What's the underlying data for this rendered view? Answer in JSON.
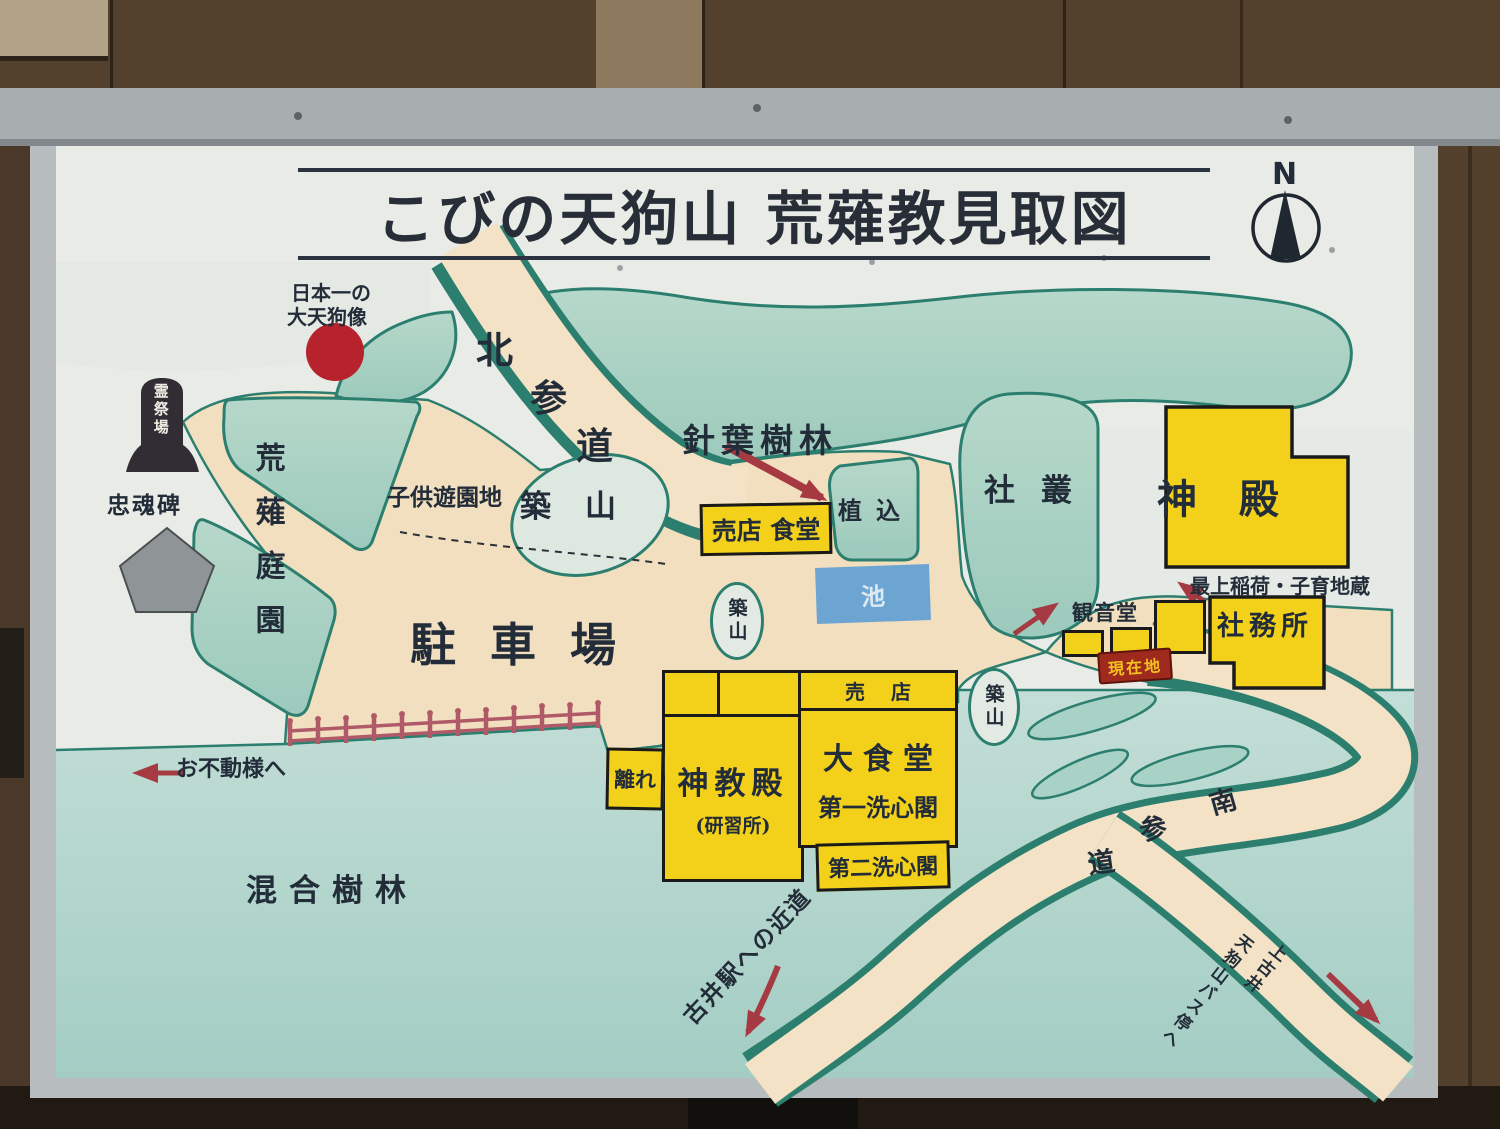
{
  "signboard": {
    "title": "こびの天狗山 荒薙教見取図",
    "compass": "N"
  },
  "areas": {
    "parking": "駐車場",
    "conifer_forest": "針葉樹林",
    "mixed_forest": "混合樹林",
    "garden": "荒薙庭園",
    "shrine_grove": "社叢",
    "children_playground": "子供遊園地",
    "mound_nw": "築山",
    "mound_center": "築山",
    "mound_east": "築山",
    "planting": "植込",
    "pond": "池"
  },
  "buildings": {
    "shop_dining": "売店 食堂",
    "main_shrine": "神殿",
    "shrine_office": "社務所",
    "kannon_hall": "観音堂",
    "shop": "売店",
    "large_dining": "大食堂",
    "first_senshinkaku": "第一洗心閣",
    "second_senshinkaku": "第二洗心閣",
    "kyoden": "神教殿",
    "kyoden_sub": "(研習所)",
    "detached_room": "離れ"
  },
  "monuments": {
    "tengu_statue_line1": "日本一の",
    "tengu_statue_line2": "大天狗像",
    "spirit_festival_ground": "霊祭場",
    "loyalty_monument": "忠魂碑",
    "mogami_inari": "最上稲荷・子育地蔵"
  },
  "markers": {
    "you_are_here": "現在地",
    "to_ofudosama": "お不動様へ",
    "station_shortcut": "古井駅への近道",
    "bus_stop_line1": "上古井",
    "bus_stop_line2": "天狗山バス停へ"
  },
  "roads": {
    "north_approach": [
      "北",
      "参",
      "道"
    ],
    "south_approach": [
      "南",
      "参",
      "道"
    ]
  },
  "colors": {
    "building_yellow": "#f3d11b",
    "path_beige": "#f1dfc0",
    "vegetation_green": "#abd2c5",
    "vegetation_edge": "#2c7f6f",
    "water_blue": "#6da5d2",
    "marker_red": "#a63a42",
    "statue_red": "#b7232c",
    "board_white": "#e9ece6",
    "frame_gray": "#b7bcbe",
    "wood_brown": "#4a3829"
  }
}
